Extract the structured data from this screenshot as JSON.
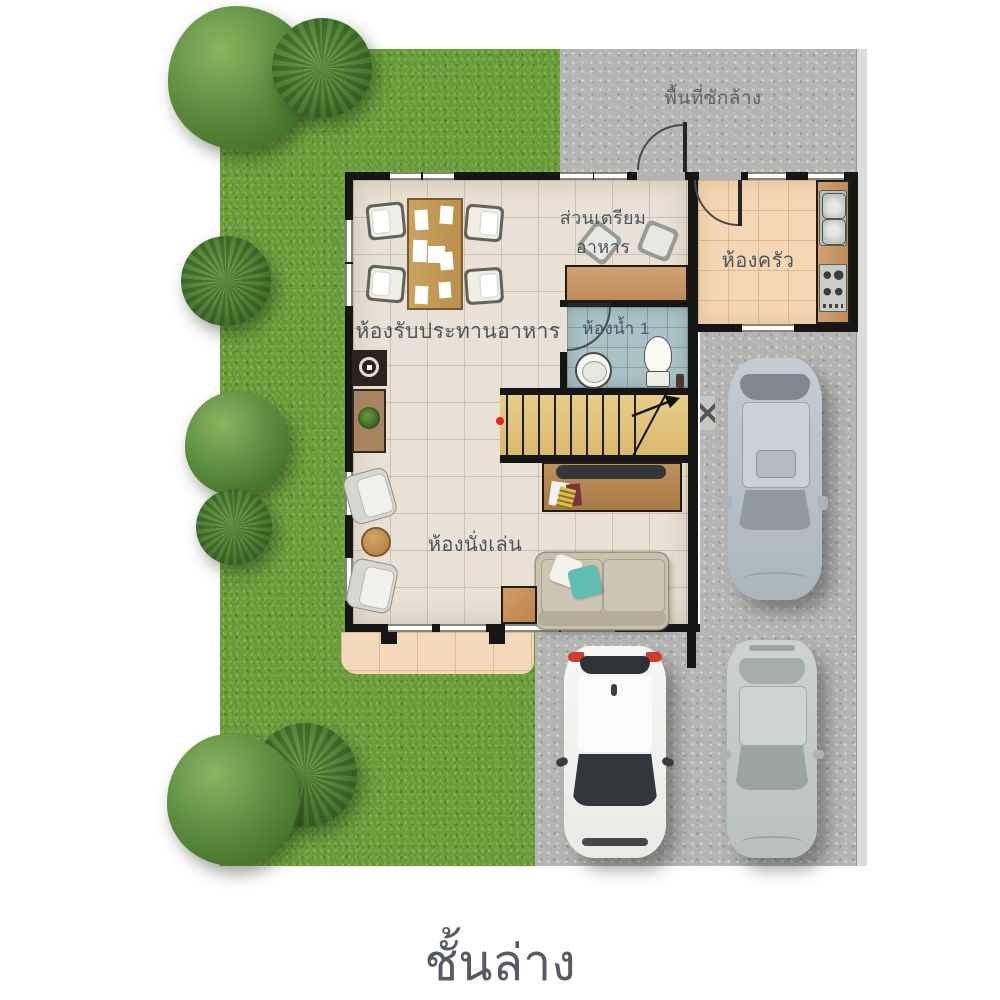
{
  "page_title": "ชั้นล่าง",
  "floor_label": "ชั้นล่าง",
  "labels": {
    "laundry": "พื้นที่ซักล้าง",
    "prep_area": "ส่วนเตรียมอาหาร",
    "kitchen": "ห้องครัว",
    "dining": "ห้องรับประทานอาหาร",
    "bathroom": "ห้องน้ำ 1",
    "living": "ห้องนั่งเล่น"
  },
  "colors": {
    "grass": "#6b9f3e",
    "concrete": "#b3b3b1",
    "wall": "#161616",
    "floor_main": "#e9e1d5",
    "floor_kitchen": "#f5d7b6",
    "floor_bathroom": "#a9c2c6",
    "stairs_wood": "#e0c27c",
    "counter_wood": "#c9996a",
    "sofa": "#c8c1af",
    "pillow_accent": "#5fbdb4",
    "label_text": "#4c555f"
  },
  "objects": {
    "vehicles": [
      "gray-suv-top-view",
      "white-hatchback-top-view",
      "silver-sedan-top-view"
    ],
    "furniture": [
      "dining-table-with-4-chairs",
      "prep-counter-with-2-stools",
      "kitchen-counter-sink-stove",
      "toilet",
      "wash-basin",
      "staircase",
      "tv-cabinet",
      "sofa-with-pillows",
      "armchairs",
      "coffee-table",
      "side-table",
      "sideboard-with-plant",
      "display-cabinet"
    ],
    "landscape": [
      "lawn",
      "trees",
      "driveway",
      "laundry-yard",
      "terrace"
    ]
  }
}
